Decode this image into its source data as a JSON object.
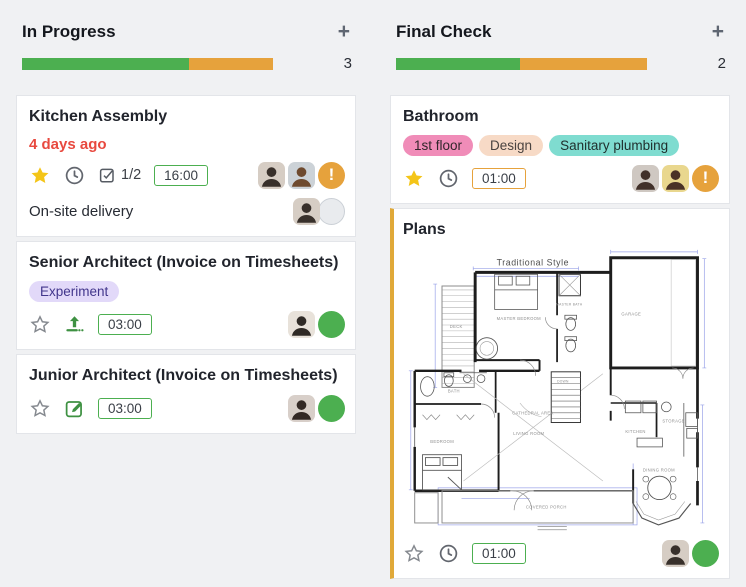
{
  "columns": [
    {
      "title": "In Progress",
      "add": "+",
      "count": "3",
      "progress_green_pct": 66.5,
      "progress_orange_pct": 33.5
    },
    {
      "title": "Final Check",
      "add": "+",
      "count": "2",
      "progress_green_pct": 49.5,
      "progress_orange_pct": 50.5
    }
  ],
  "colors": {
    "progress_green": "#4CAF50",
    "progress_orange": "#E6A23C",
    "overdue_red": "#E8493F",
    "star_yellow": "#F4C518",
    "card_stripe_yellow": "#E0A939"
  },
  "cards": {
    "kitchen": {
      "title": "Kitchen Assembly",
      "due": "4 days ago",
      "checklist": "1/2",
      "time": "16:00",
      "alert": "!",
      "subtask": {
        "title": "On-site delivery"
      }
    },
    "senior": {
      "title": "Senior Architect (Invoice on Timesheets)",
      "tag": "Experiment",
      "time": "03:00"
    },
    "junior": {
      "title": "Junior Architect (Invoice on Timesheets)",
      "time": "03:00"
    },
    "bathroom": {
      "title": "Bathroom",
      "tags": [
        "1st floor",
        "Design",
        "Sanitary plumbing"
      ],
      "time": "01:00",
      "alert": "!"
    },
    "plans": {
      "title": "Plans",
      "time": "01:00",
      "plan": {
        "style": "Traditional Style",
        "deck": "DECK",
        "master_bedroom": "MASTER BEDROOM",
        "master_bath": "MASTER BATH",
        "garage": "GARAGE",
        "bath": "BATH",
        "bedroom": "BEDROOM",
        "cathedral": "CATHEDRAL AREA",
        "living": "LIVING ROOM",
        "porch": "COVERED PORCH",
        "kitchen": "KITCHEN",
        "dining": "DINING ROOM",
        "storage": "STORAGE",
        "down": "DOWN"
      }
    }
  }
}
